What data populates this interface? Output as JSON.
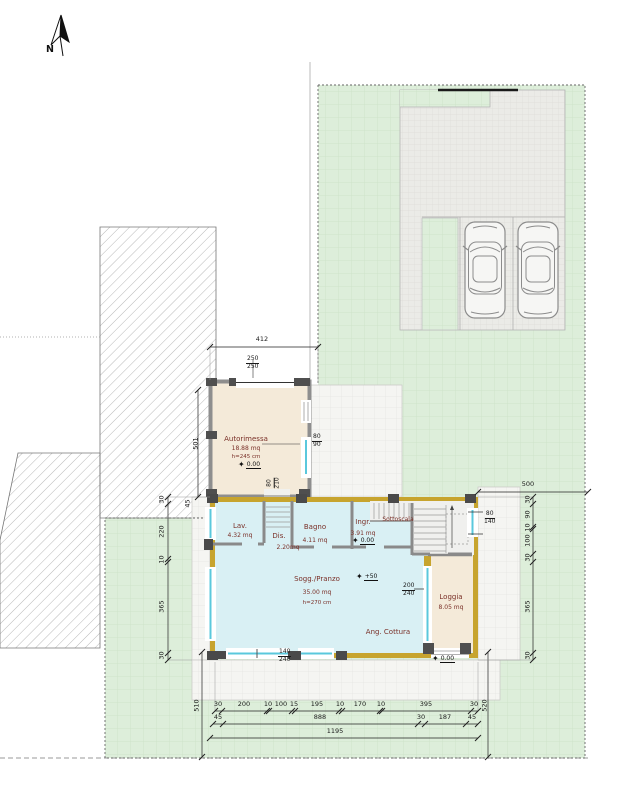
{
  "north_label": "N",
  "rooms": {
    "autorimessa": {
      "name": "Autorimessa",
      "area": "18.88 mq",
      "height": "h=245 cm",
      "level": "0.00"
    },
    "lav": {
      "name": "Lav.",
      "area": "4.32 mq"
    },
    "dis": {
      "name": "Dis.",
      "area": "2.20mq"
    },
    "bagno": {
      "name": "Bagno",
      "area": "4.11 mq"
    },
    "ingr": {
      "name": "Ingr.",
      "area": "3.91 mq",
      "level": "0.00"
    },
    "sottoscala": {
      "name": "Sottoscala"
    },
    "soggiorno": {
      "name": "Sogg./Pranzo",
      "area": "35.00 mq",
      "height": "h=270 cm",
      "level": "+50"
    },
    "ang_cottura": {
      "name": "Ang. Cottura"
    },
    "loggia": {
      "name": "Loggia",
      "area": "8.05 mq"
    },
    "outdoor_level": "0.00"
  },
  "openings": {
    "garage_door": {
      "w": "250",
      "h": "250"
    },
    "garage_window": {
      "w": "80",
      "h": "90"
    },
    "internal_door": {
      "w": "80",
      "h": "210"
    },
    "stair_window": {
      "w": "80",
      "h": "140"
    },
    "living_glazing": {
      "w": "200",
      "h": "240"
    },
    "south_door": {
      "w": "140",
      "h": "240"
    }
  },
  "dimensions": {
    "garage_front": "412",
    "hatch_side": "501",
    "corner_offset": "45",
    "left_chain": [
      "30",
      "220",
      "10",
      "365",
      "30"
    ],
    "right_chain": [
      "30",
      "90",
      "10",
      "100",
      "30",
      "365",
      "30"
    ],
    "east_offset": "500",
    "bottom_row1": [
      "30",
      "200",
      "10",
      "100",
      "15",
      "195",
      "10",
      "170",
      "10",
      "395",
      "30"
    ],
    "bottom_row2": [
      "45",
      "888",
      "30",
      "187",
      "45"
    ],
    "bottom_total": "1195",
    "south_left": "510",
    "south_right": "520"
  },
  "colors": {
    "lawn": "#ddeeda",
    "paving": "#ebebe7",
    "apron": "#f5f5f2",
    "house_wall": "#c7a42e",
    "living_fill": "#d9f0f4",
    "garage_fill": "#f4ead9",
    "window_glass": "#5ac8dc",
    "room_label": "#7a3028"
  }
}
